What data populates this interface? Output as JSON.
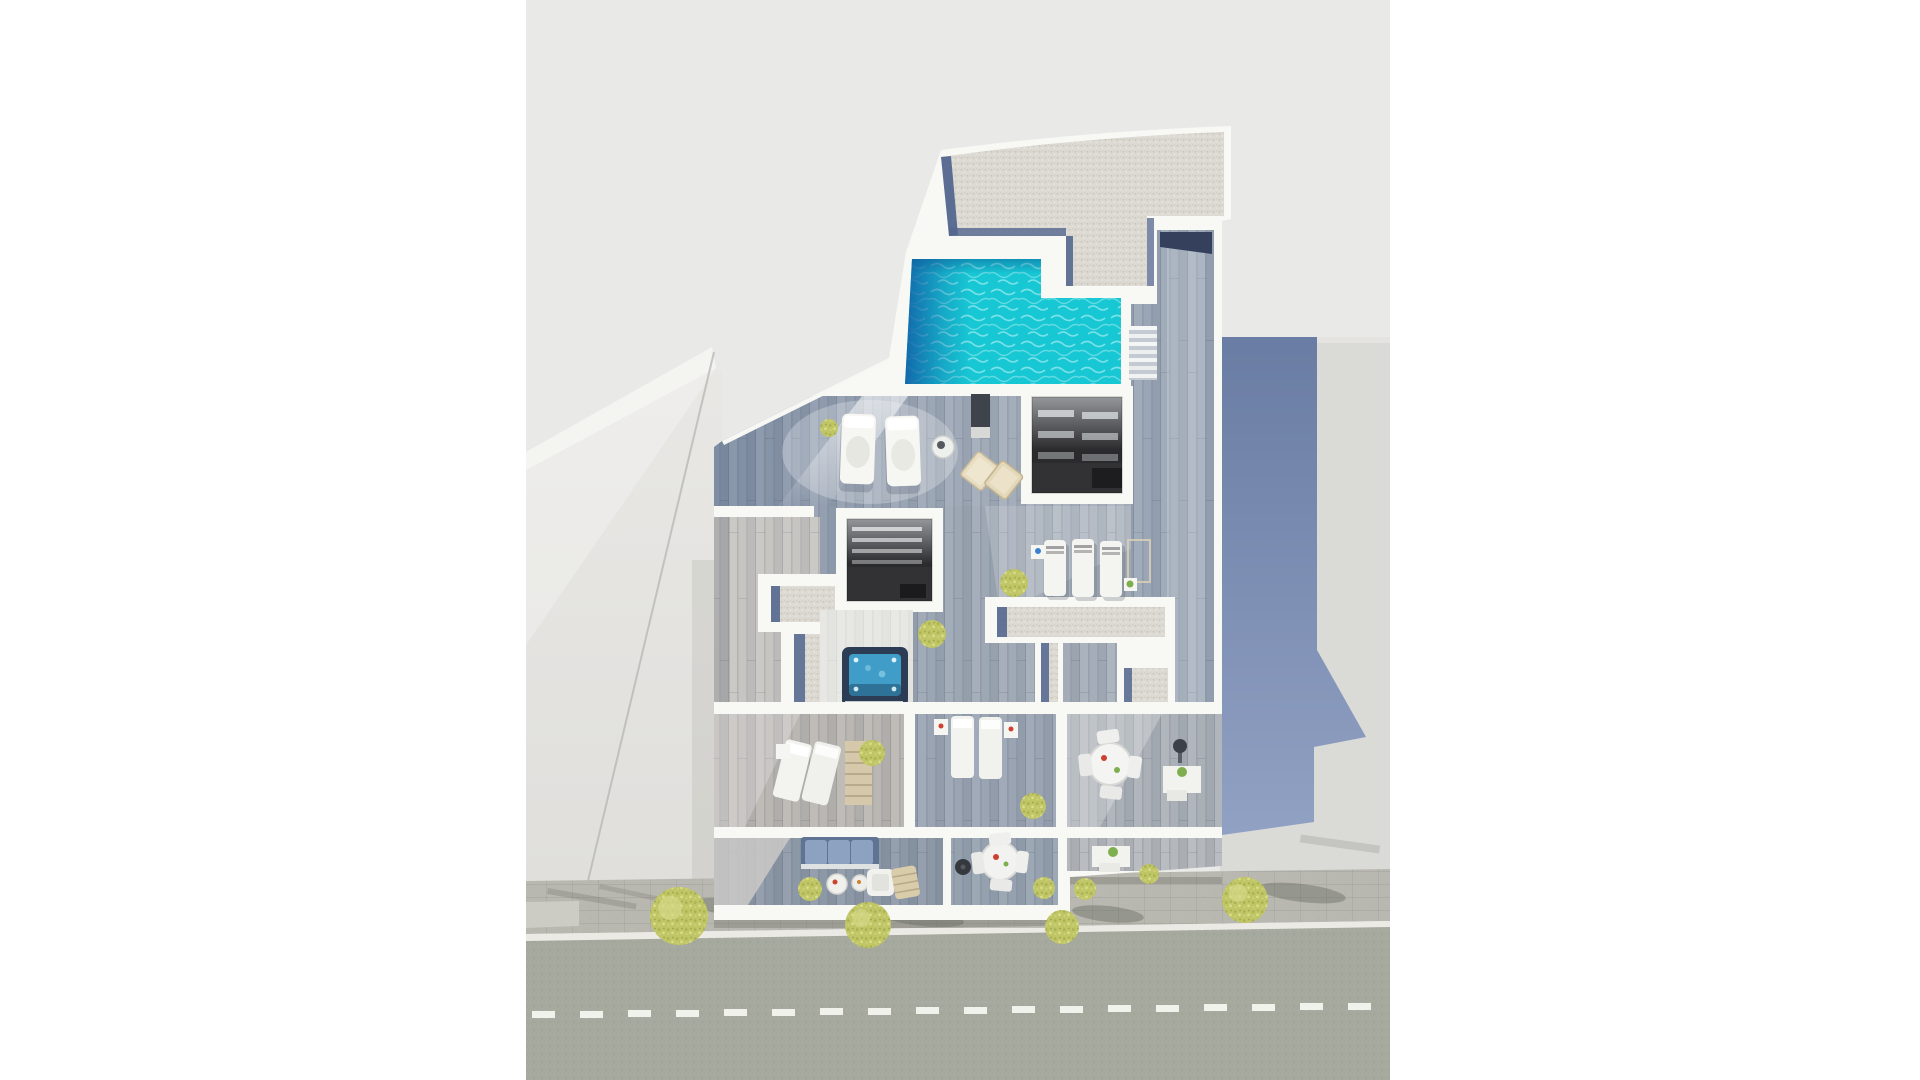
{
  "scene": {
    "title": "Aerial top-down 3D render of a rooftop apartment level with swimming pool, terraces and street",
    "type": "architectural-visualization",
    "view": "top-down aerial"
  },
  "palette": {
    "page_bg": "#ffffff",
    "backdrop": "#e9e9e7",
    "wall_white": "#f8f8f5",
    "gravel": "#dcd9d2",
    "gravel_blue_edge": "#54678f",
    "pool_teal": "#17c7d4",
    "pool_deep_blue": "#1264a8",
    "deck_shaded": "#8494aa",
    "deck_mid": "#9aa6b5",
    "deck_light": "#c7c5c1",
    "terrace_left": "#bab7b3",
    "terrace_mid": "#9aa4b3",
    "terrace_right": "#abb0b7",
    "balcony_left": "#8d98a7",
    "balcony_mid": "#96a1af",
    "balcony_right": "#b4b7bb",
    "skylight_dark": "#323235",
    "hot_tub_shell": "#2c3c55",
    "hot_tub_water": "#3f9dc8",
    "sidewalk": "#b8b7b0",
    "curb": "#eceae5",
    "asphalt": "#a6a99d",
    "lane_dash": "#f1f2ec",
    "neighbor_left": "#e6e5e2",
    "neighbor_right": "#dadad7",
    "cast_shadow_blue": "#677ca6",
    "tree_green": "#c0c566"
  },
  "objects": {
    "building": "white apartment building rooftop level",
    "pool": "L-shaped rooftop swimming pool with turquoise water",
    "roof": "flat gravel roof with parapets",
    "skylight_wells": 2,
    "hot_tub": "square hot tub on white terrace",
    "outdoor_shower": 1,
    "sun_loungers": 9,
    "deck_chairs": 2,
    "dining_sets": 2,
    "outdoor_sofa": "blue cushioned sofa",
    "stairs": "side stair between deck levels",
    "terraces": 3,
    "balconies": 3,
    "street": "two-lane road with white dashed center line",
    "street_trees": 4,
    "neighbor_buildings": 2
  }
}
